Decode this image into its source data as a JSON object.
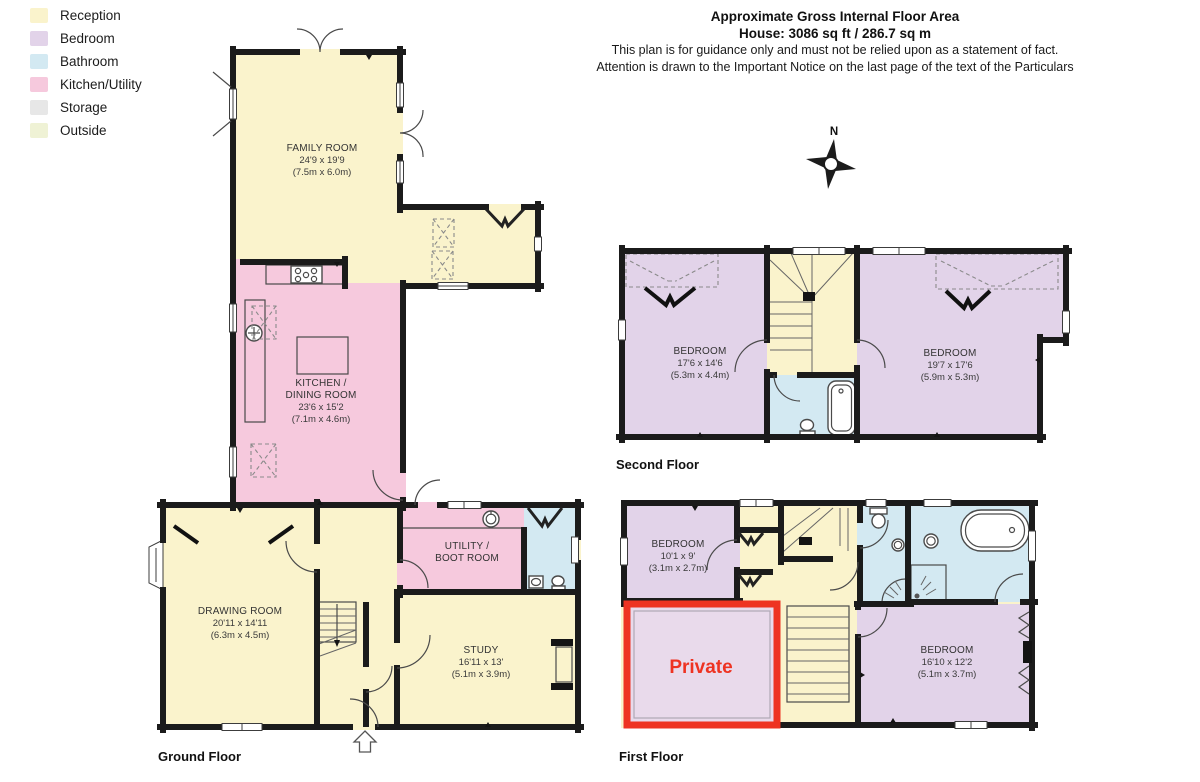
{
  "legend": {
    "items": [
      {
        "label": "Reception",
        "color": "#FAF3CC"
      },
      {
        "label": "Bedroom",
        "color": "#E2D3E9"
      },
      {
        "label": "Bathroom",
        "color": "#D3E9F2"
      },
      {
        "label": "Kitchen/Utility",
        "color": "#F6C9DD"
      },
      {
        "label": "Storage",
        "color": "#E7E7E7"
      },
      {
        "label": "Outside",
        "color": "#EFF2D5"
      }
    ]
  },
  "header": {
    "title": "Approximate Gross Internal Floor Area",
    "subtitle": "House: 3086 sq ft / 286.7 sq m",
    "note1": "This plan is for guidance only and must not be relied upon as a statement of fact.",
    "note2": "Attention is drawn to the Important Notice on the last page of the text of the Particulars"
  },
  "compass": {
    "north": "N"
  },
  "colors": {
    "reception": "#FAF3CC",
    "bedroom": "#E2D3E9",
    "bathroom": "#D3E9F2",
    "kitchen": "#F6C9DD",
    "storage": "#E7E7E7",
    "outside": "#EFF2D5",
    "wall": "#1B1B1B",
    "private_red": "#EE3322",
    "private_fill": "#E9DAEB",
    "label_text": "#333333"
  },
  "floors": {
    "ground": {
      "label": "Ground Floor",
      "rooms": {
        "family_room": {
          "name": "FAMILY ROOM",
          "imperial": "24'9 x 19'9",
          "metric": "(7.5m x 6.0m)"
        },
        "kitchen": {
          "name": "KITCHEN /",
          "name2": "DINING ROOM",
          "imperial": "23'6 x 15'2",
          "metric": "(7.1m x 4.6m)"
        },
        "drawing_room": {
          "name": "DRAWING ROOM",
          "imperial": "20'11 x 14'11",
          "metric": "(6.3m x 4.5m)"
        },
        "utility": {
          "name": "UTILITY /",
          "name2": "BOOT ROOM"
        },
        "study": {
          "name": "STUDY",
          "imperial": "16'11 x 13'",
          "metric": "(5.1m x 3.9m)"
        }
      }
    },
    "second": {
      "label": "Second Floor",
      "rooms": {
        "bedroom_left": {
          "name": "BEDROOM",
          "imperial": "17'6 x 14'6",
          "metric": "(5.3m x 4.4m)"
        },
        "bedroom_right": {
          "name": "BEDROOM",
          "imperial": "19'7 x 17'6",
          "metric": "(5.9m x 5.3m)"
        }
      }
    },
    "first": {
      "label": "First Floor",
      "rooms": {
        "bedroom_small": {
          "name": "BEDROOM",
          "imperial": "10'1 x 9'",
          "metric": "(3.1m x 2.7m)"
        },
        "private": {
          "name": "Private"
        },
        "bedroom": {
          "name": "BEDROOM",
          "imperial": "16'10 x 12'2",
          "metric": "(5.1m x 3.7m)"
        }
      }
    }
  }
}
